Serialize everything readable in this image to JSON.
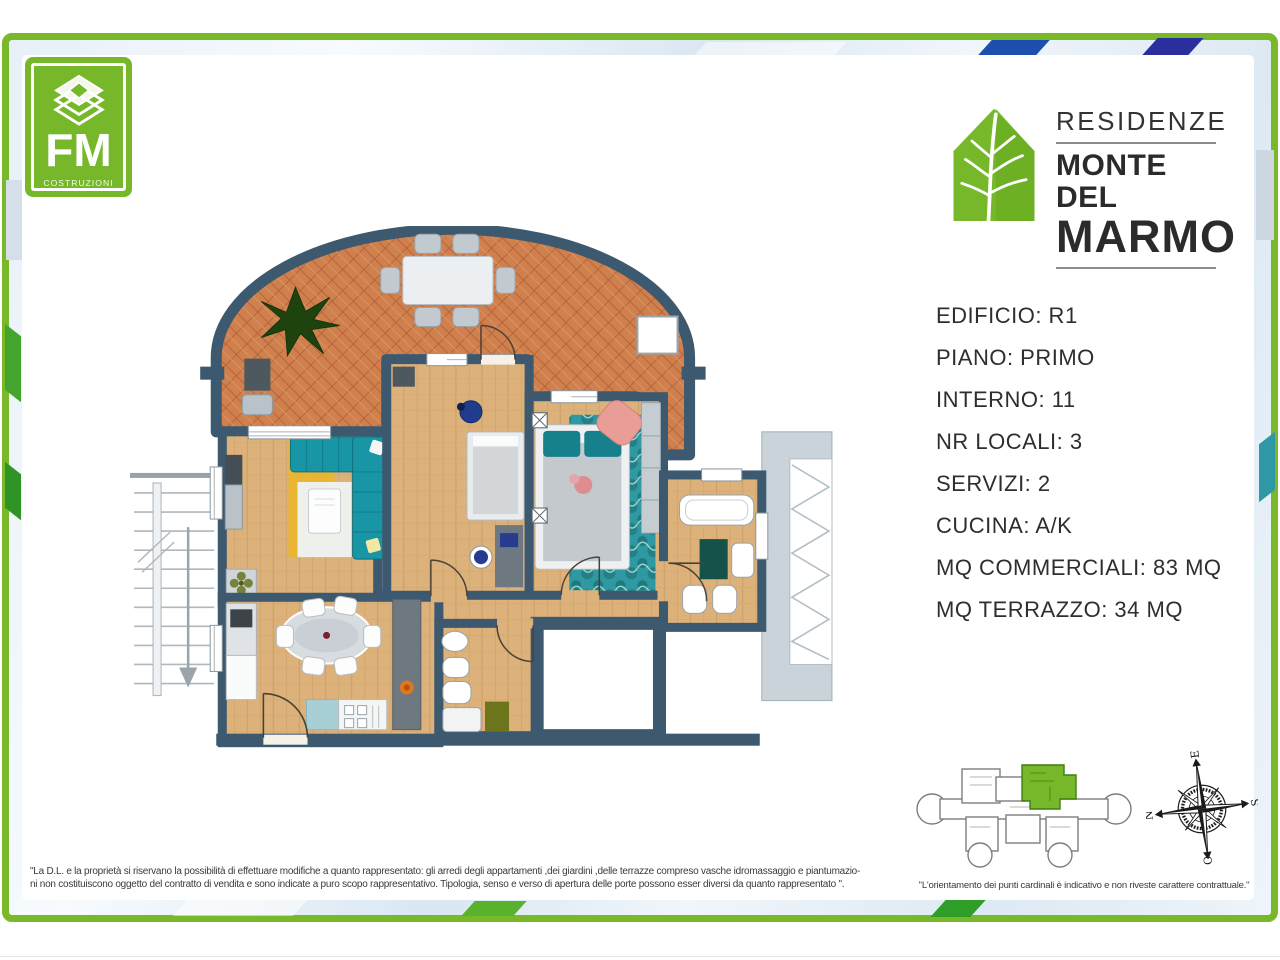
{
  "fm_logo": {
    "brand": "FM",
    "subtitle": "COSTRUZIONI",
    "green": "#76b82a"
  },
  "residence_logo": {
    "line1": "RESIDENZE",
    "line2": "MONTE DEL",
    "line3": "MARMO",
    "leaf_green": "#76b82a"
  },
  "details": {
    "items": [
      "EDIFICIO: R1",
      "PIANO: PRIMO",
      "INTERNO: 11",
      "NR LOCALI: 3",
      "SERVIZI: 2",
      "CUCINA: A/K",
      "MQ COMMERCIALI: 83 MQ",
      "MQ TERRAZZO: 34 MQ"
    ]
  },
  "disclaimer": {
    "line1": "\"La D.L. e la proprietà si riservano la possibilità di effettuare modifiche a quanto rappresentato: gli arredi degli appartamenti ,dei giardini ,delle terrazze compreso vasche idromassaggio e piantumazio-",
    "line2": "ni non costituiscono oggetto del contratto di vendita e sono indicate a puro scopo rappresentativo. Tipologia, senso e verso di apertura delle porte possono esser diversi da quanto rappresentato \"."
  },
  "keyplan": {
    "caption": "\"L'orientamento dei punti cardinali è indicativo e non riveste carattere contrattuale.\""
  },
  "compass": {
    "n": "N",
    "e": "E",
    "s": "S",
    "o": "O"
  },
  "colors": {
    "frame_green": "#79b829",
    "brand_green": "#76b82a",
    "wall": "#3d5970",
    "terracotta": "#d0804c",
    "wood": "#dcb17a",
    "sofa_teal": "#1896a6",
    "rug_yellow": "#e9b52c",
    "rug_teal": "#2e99a0"
  }
}
